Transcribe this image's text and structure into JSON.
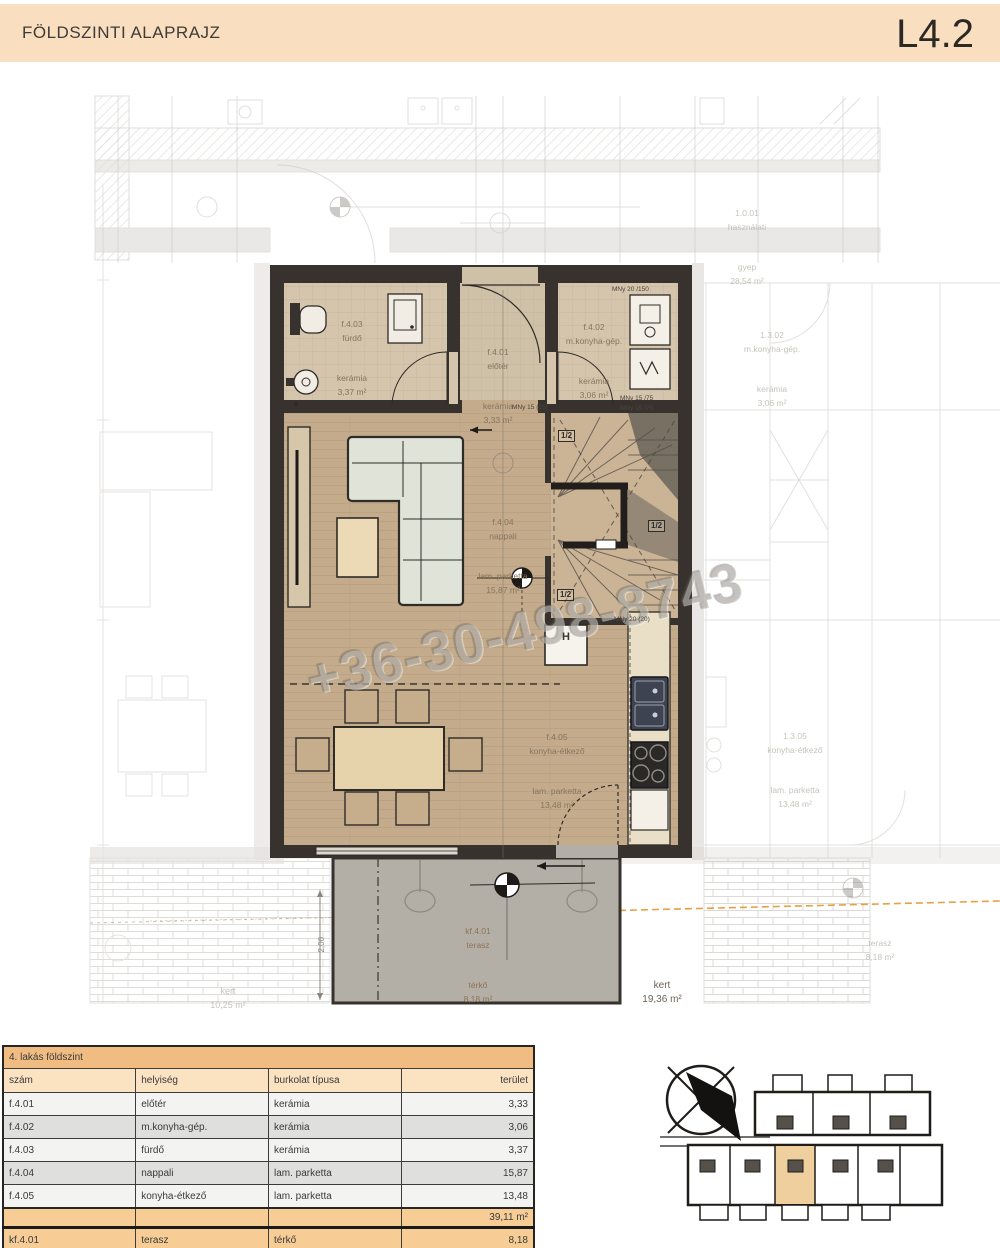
{
  "header": {
    "title": "FÖLDSZINTI ALAPRAJZ",
    "code": "L4.2"
  },
  "watermark": "+36-30-498-8743",
  "colors": {
    "header_bg": "#f9dfc0",
    "table_title_bg": "#f1bc81",
    "table_header_bg": "#fbe2c1",
    "table_sum_bg": "#f7cc95",
    "keyplan_highlight": "#f0cf9f",
    "survey_line_orange": "#e2972e",
    "wall_dark": "#37322d",
    "floor_tan": "#c3ab8c",
    "terrace_gray": "#b4afa6"
  },
  "plan": {
    "rooms": {
      "eloter": {
        "id": "f.4.01",
        "name": "előtér",
        "floor": "kerámia",
        "area": "3,33 m²"
      },
      "mkonyha": {
        "id": "f.4.02",
        "name": "m.konyha-gép.",
        "floor": "kerámia",
        "area": "3,06 m²"
      },
      "furdo": {
        "id": "f.4.03",
        "name": "fürdő",
        "floor": "kerámia",
        "area": "3,37 m²"
      },
      "nappali": {
        "id": "f.4.04",
        "name": "nappali",
        "floor": "lam. parketta",
        "area": "15,87 m²"
      },
      "konyha": {
        "id": "f.4.05",
        "name": "konyha-étkező",
        "floor": "lam. parketta",
        "area": "13,48 m²"
      },
      "terasz": {
        "id": "kf.4.01",
        "name": "terasz",
        "floor": "térkő",
        "area": "8,18 m²"
      }
    },
    "labels": {
      "kert_left_1": "kert",
      "kert_left_2": "10,25 m²",
      "kert_right_1": "kert",
      "kert_right_2": "19,36 m²",
      "neighbor_top_1": "1.0.01",
      "neighbor_top_2": "használati",
      "neighbor_top_3": "gyep",
      "neighbor_top_4": "28,54 m²",
      "nb_right_top_1": "1.3.02",
      "nb_right_top_2": "m.konyha-gép.",
      "nb_right_top_3": "kerámia",
      "nb_right_top_4": "3,06 m²",
      "nb_right_mid_1": "1.3.05",
      "nb_right_mid_2": "konyha-étkező",
      "nb_right_mid_3": "lam. parketta",
      "nb_right_mid_4": "13,48 m²",
      "nb_right_ter_1": "terasz",
      "nb_right_ter_2": "8,18 m²",
      "dim_200": "2,00",
      "mny_20_150": "MNy 20 /150",
      "mny_15_75a": "MNy 15 /75",
      "mny_15_75b": "MNy 15 /75",
      "mny_15_15": "MNy 15 (15)",
      "mny_20_20": "MNy 20 (20)",
      "stair_half": "1/2",
      "closet_h": "H"
    }
  },
  "table": {
    "title": "4. lakás földszint",
    "headers": [
      "szám",
      "helyiség",
      "burkolat típusa",
      "terület"
    ],
    "rows": [
      [
        "f.4.01",
        "előtér",
        "kerámia",
        "3,33"
      ],
      [
        "f.4.02",
        "m.konyha-gép.",
        "kerámia",
        "3,06"
      ],
      [
        "f.4.03",
        "fürdő",
        "kerámia",
        "3,37"
      ],
      [
        "f.4.04",
        "nappali",
        "lam. parketta",
        "15,87"
      ],
      [
        "f.4.05",
        "konyha-étkező",
        "lam. parketta",
        "13,48"
      ]
    ],
    "total": "39,11 m²",
    "terrace_row": {
      "num": "kf.4.01",
      "name": "terasz",
      "floor": "térkő",
      "area": "8,18"
    }
  }
}
